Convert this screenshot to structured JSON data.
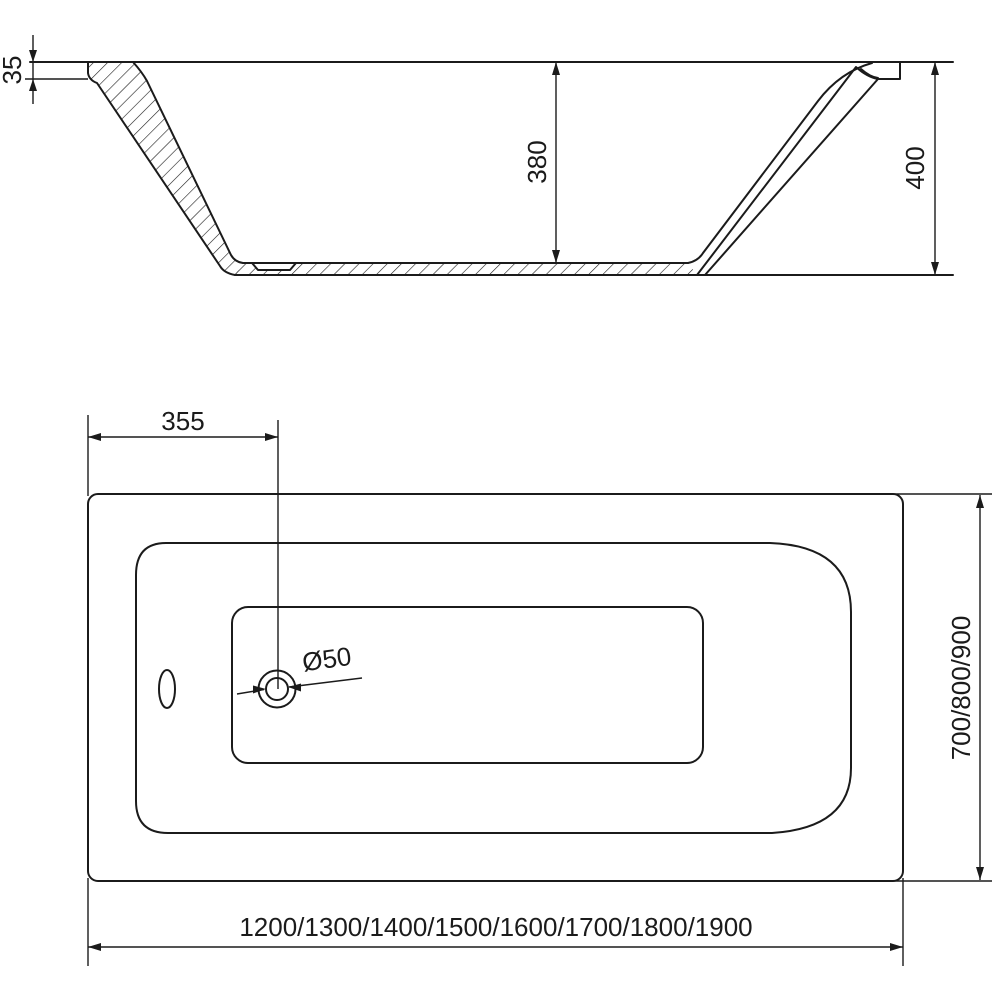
{
  "drawing": {
    "background_color": "#ffffff",
    "line_color": "#1b1b1b",
    "section_view": {
      "description": "bathtub side section view",
      "dimensions": {
        "rim_thickness": "35",
        "inner_depth": "380",
        "overall_height": "400"
      }
    },
    "plan_view": {
      "description": "bathtub top plan view",
      "dimensions": {
        "drain_center_offset": "355",
        "drain_diameter": "Ø50",
        "width_variants": "700/800/900",
        "length_variants": "1200/1300/1400/1500/1600/1700/1800/1900"
      }
    }
  }
}
